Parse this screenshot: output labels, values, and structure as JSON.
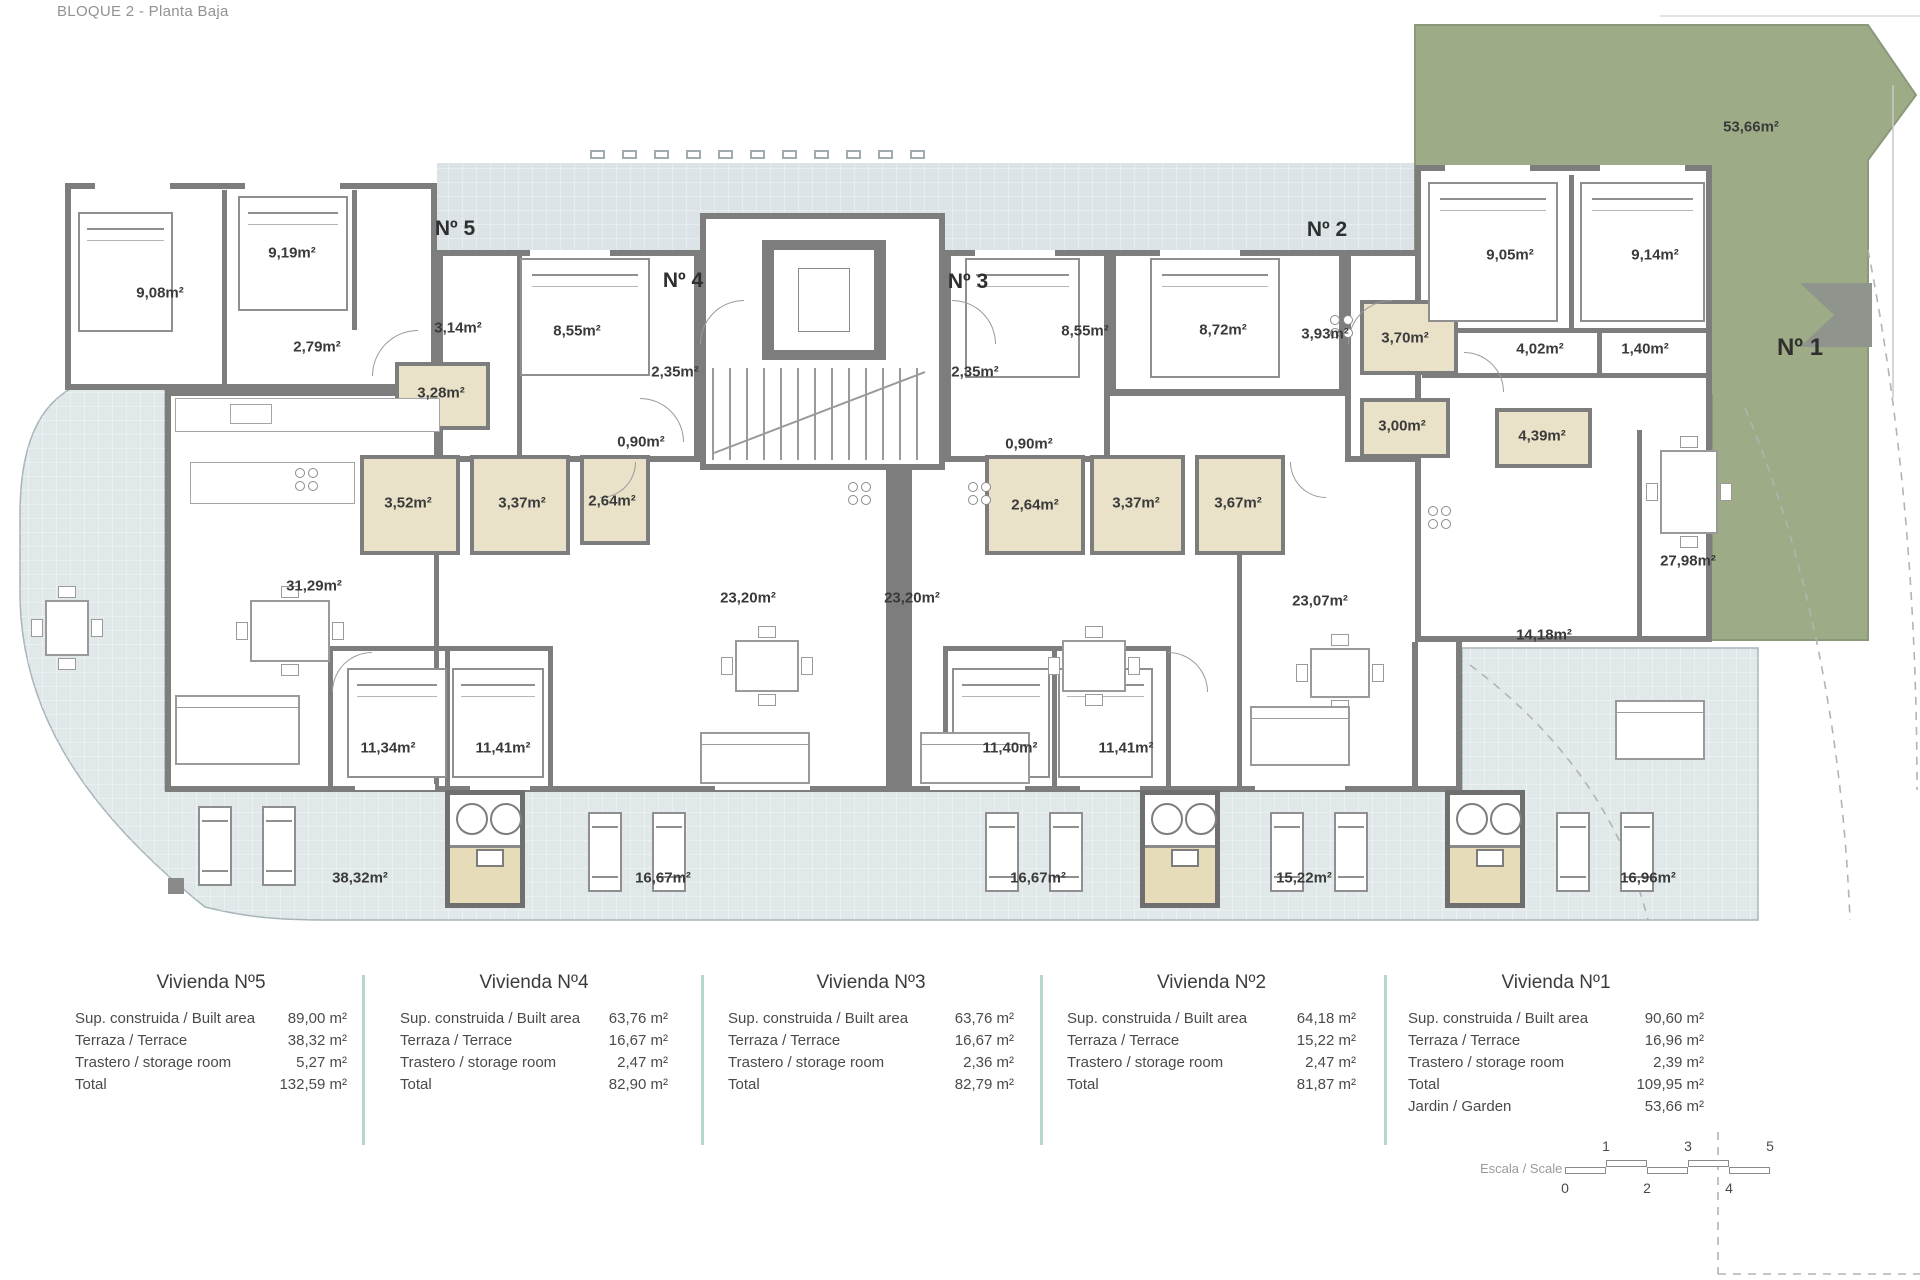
{
  "title": "BLOQUE 2 - Planta Baja",
  "plan": {
    "unit_labels": [
      "Nº 5",
      "Nº 4",
      "Nº 3",
      "Nº 2",
      "Nº 1"
    ],
    "room_labels": [
      "9,08m²",
      "9,19m²",
      "2,79m²",
      "3,14m²",
      "3,28m²",
      "8,55m²",
      "2,35m²",
      "0,90m²",
      "3,52m²",
      "3,37m²",
      "2,64m²",
      "31,29m²",
      "23,20m²",
      "23,20m²",
      "11,34m²",
      "11,41m²",
      "8,55m²",
      "8,72m²",
      "3,93m²",
      "2,35m²",
      "0,90m²",
      "2,64m²",
      "3,37m²",
      "3,67m²",
      "3,70m²",
      "3,00m²",
      "23,07m²",
      "11,40m²",
      "11,41m²",
      "9,05m²",
      "9,14m²",
      "4,02m²",
      "1,40m²",
      "4,39m²",
      "14,18m²",
      "27,98m²"
    ],
    "terrace_labels": [
      "38,32m²",
      "16,67m²",
      "16,67m²",
      "15,22m²",
      "16,96m²"
    ],
    "garden_label": "53,66m²"
  },
  "tables": [
    {
      "title": "Vivienda Nº5",
      "rows": [
        [
          "Sup. construida / Built area",
          "89,00 m²"
        ],
        [
          "Terraza / Terrace",
          "38,32 m²"
        ],
        [
          "Trastero / storage room",
          "5,27 m²"
        ],
        [
          "Total",
          "132,59 m²"
        ]
      ]
    },
    {
      "title": "Vivienda Nº4",
      "rows": [
        [
          "Sup. construida / Built area",
          "63,76 m²"
        ],
        [
          "Terraza / Terrace",
          "16,67 m²"
        ],
        [
          "Trastero / storage room",
          "2,47 m²"
        ],
        [
          "Total",
          "82,90 m²"
        ]
      ]
    },
    {
      "title": "Vivienda Nº3",
      "rows": [
        [
          "Sup. construida / Built area",
          "63,76 m²"
        ],
        [
          "Terraza / Terrace",
          "16,67 m²"
        ],
        [
          "Trastero / storage room",
          "2,36 m²"
        ],
        [
          "Total",
          "82,79 m²"
        ]
      ]
    },
    {
      "title": "Vivienda Nº2",
      "rows": [
        [
          "Sup. construida / Built area",
          "64,18 m²"
        ],
        [
          "Terraza / Terrace",
          "15,22 m²"
        ],
        [
          "Trastero / storage room",
          "2,47 m²"
        ],
        [
          "Total",
          "81,87 m²"
        ]
      ]
    },
    {
      "title": "Vivienda Nº1",
      "rows": [
        [
          "Sup. construida / Built area",
          "90,60 m²"
        ],
        [
          "Terraza / Terrace",
          "16,96 m²"
        ],
        [
          "Trastero / storage room",
          "2,39 m²"
        ],
        [
          "Total",
          "109,95 m²"
        ],
        [
          "Jardin / Garden",
          "53,66 m²"
        ]
      ]
    }
  ],
  "scale": {
    "label": "Escala / Scale",
    "ticks_top": [
      "1",
      "3",
      "5"
    ],
    "ticks_bottom": [
      "0",
      "2",
      "4"
    ]
  },
  "colors": {
    "wall": "#7d7d7d",
    "terrace": "#e0e8ea",
    "walkway": "#dbe3e6",
    "garden": "#9dac86",
    "bath": "#e9e2c9",
    "separator": "#b7d6cd"
  }
}
